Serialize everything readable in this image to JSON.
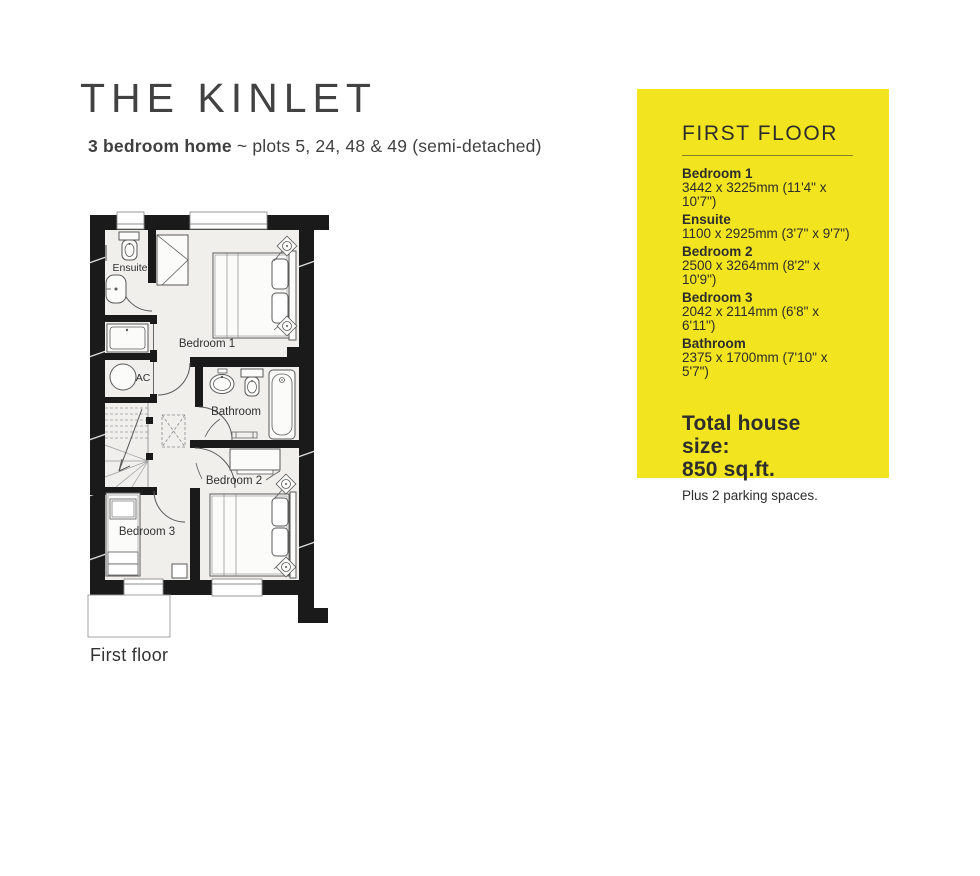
{
  "header": {
    "title": "THE KINLET",
    "subtitle_bold": "3 bedroom home",
    "subtitle_tilde": "~",
    "subtitle_rest": "plots 5, 24, 48 & 49 (semi-detached)"
  },
  "plan": {
    "floor_label": "First floor",
    "labels": {
      "ensuite": "Ensuite",
      "bedroom1": "Bedroom 1",
      "ac": "AC",
      "bathroom": "Bathroom",
      "bedroom2": "Bedroom 2",
      "bedroom3": "Bedroom 3"
    }
  },
  "panel": {
    "heading": "FIRST FLOOR",
    "rooms": [
      {
        "name": "Bedroom 1",
        "dims": "3442 x 3225mm (11'4\" x 10'7\")"
      },
      {
        "name": "Ensuite",
        "dims": "1100 x 2925mm (3'7\" x 9'7\")"
      },
      {
        "name": "Bedroom 2",
        "dims": "2500 x 3264mm (8'2\" x 10'9\")"
      },
      {
        "name": "Bedroom 3",
        "dims": "2042 x 2114mm (6'8\" x 6'11\")"
      },
      {
        "name": "Bathroom",
        "dims": "2375 x 1700mm (7'10\" x 5'7\")"
      }
    ],
    "total_label": "Total house size:",
    "total_value": "850 sq.ft.",
    "parking": "Plus 2 parking spaces.",
    "bg_color": "#f2e41e",
    "text_color": "#2d2d2d"
  },
  "colors": {
    "wall": "#1a1a1a",
    "floor_fill": "#f0efec",
    "fixture_stroke": "#5a5a5a"
  }
}
